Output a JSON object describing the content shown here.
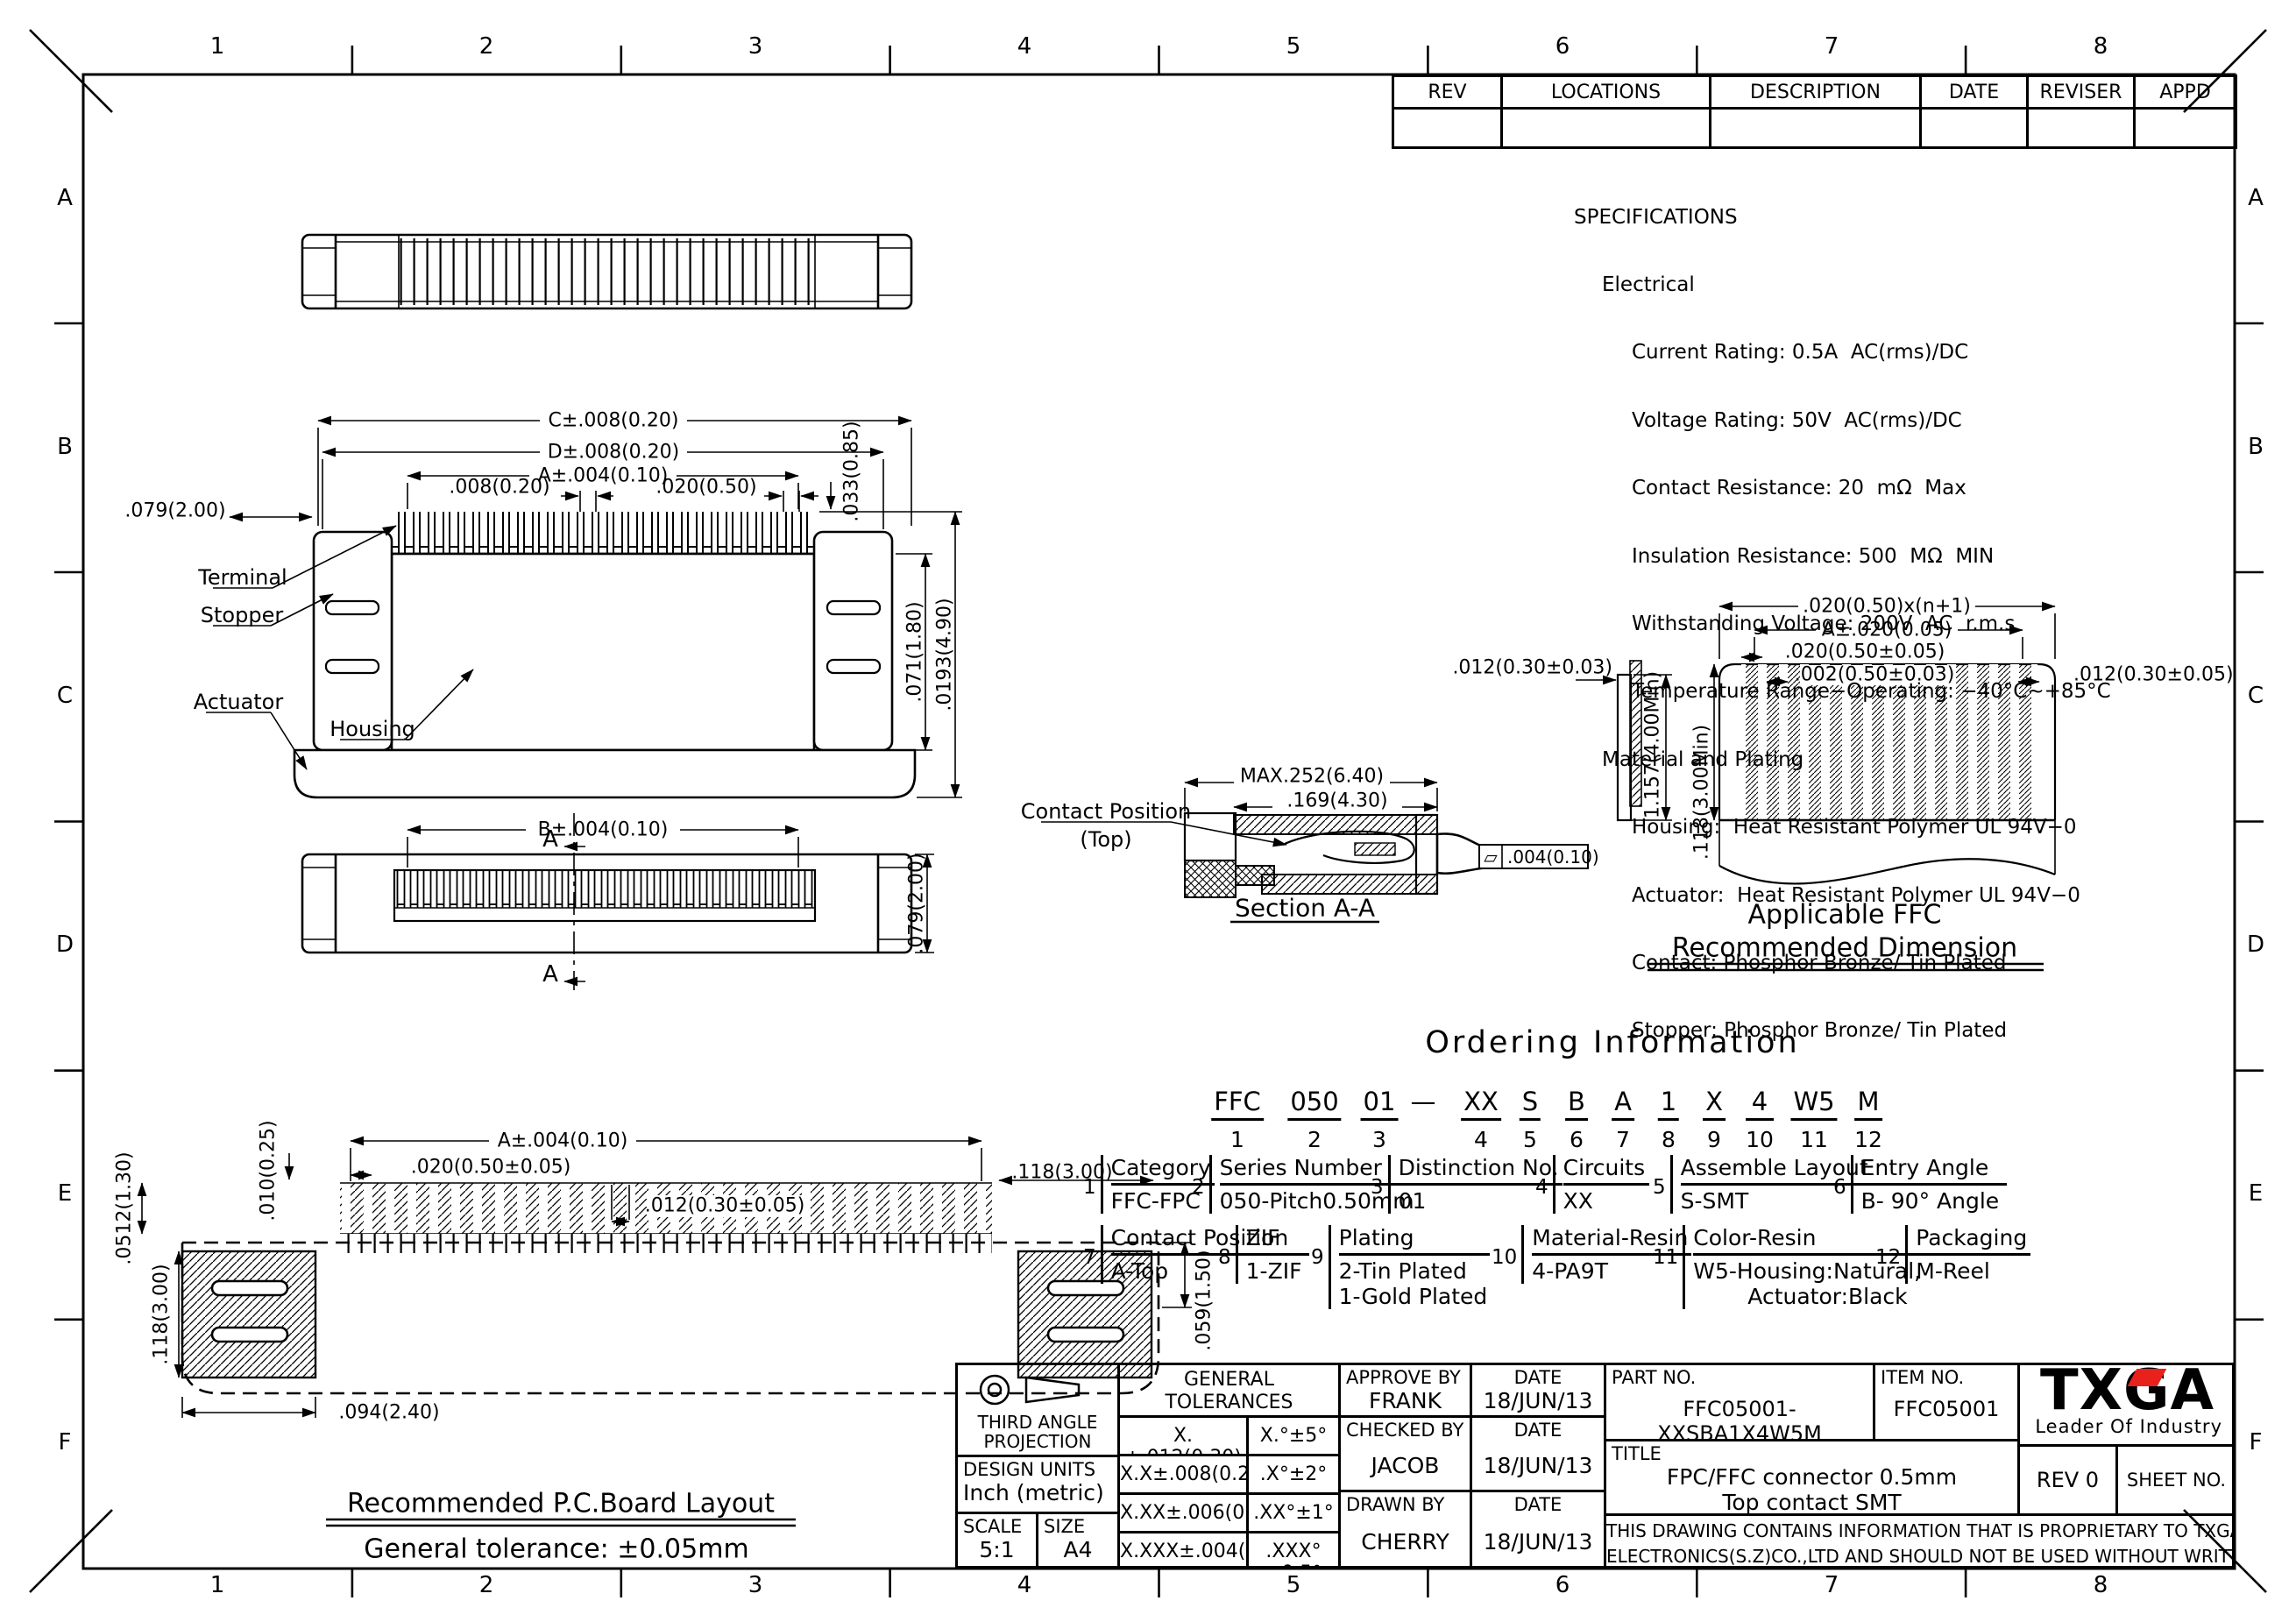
{
  "page": {
    "bg": "#ffffff",
    "ink": "#000000",
    "accent_red": "#e8211d"
  },
  "frame": {
    "cols": [
      "1",
      "2",
      "3",
      "4",
      "5",
      "6",
      "7",
      "8"
    ],
    "rows": [
      "A",
      "B",
      "C",
      "D",
      "E",
      "F"
    ]
  },
  "rev_table": {
    "headers": [
      "REV",
      "LOCATIONS",
      "DESCRIPTION",
      "DATE",
      "REVISER",
      "APPD"
    ]
  },
  "specs": {
    "title": "SPECIFICATIONS",
    "s1_head": "Electrical",
    "s1_lines": [
      "Current Rating: 0.5A  AC(rms)/DC",
      "Voltage Rating: 50V  AC(rms)/DC",
      "Contact Resistance: 20  mΩ  Max",
      "Insulation Resistance: 500  MΩ  MIN",
      "Withstanding Voltage: 200V  AC  r.m.s",
      "Temperature Range−Operating: −40°C~+85°C"
    ],
    "s2_head": "Material and Plating",
    "s2_lines": [
      "Housing:  Heat Resistant Polymer UL 94V−0",
      "Actuator:  Heat Resistant Polymer UL 94V−0",
      "Contact: Phosphor Bronze/ Tin Plated",
      "Stopper: Phosphor Bronze/ Tin Plated"
    ]
  },
  "views": {
    "front": {
      "dim_c": "C±.008(0.20)",
      "dim_d": "D±.008(0.20)",
      "dim_a": "A±.004(0.10)",
      "dim_pitch_a": ".008(0.20)",
      "dim_pitch_b": ".020(0.50)",
      "dim_left": ".079(2.00)",
      "dim_top": ".033(0.85)",
      "dim_h1": ".071(1.80)",
      "dim_h2": ".0193(4.90)",
      "terminal": "Terminal",
      "stopper": "Stopper",
      "actuator": "Actuator",
      "housing": "Housing"
    },
    "bottom": {
      "dim_b": "B±.004(0.10)",
      "dim_h": ".079(2.00)",
      "section": "A"
    },
    "section": {
      "dim_max": "MAX.252(6.40)",
      "dim_inner": ".169(4.30)",
      "contact_1": "Contact Position",
      "contact_2": "(Top)",
      "flat_sym": "▱",
      "flat_val": ".004(0.10)",
      "caption": "Section A-A"
    },
    "ffc": {
      "dim_thk": ".012(0.30±0.03)",
      "dim_len": "1.157(4.00Min)",
      "dim_exp": ".118(3.00Min)",
      "dim_total": ".020(0.50)x(n+1)",
      "dim_a": "A±.020(0.05)",
      "dim_pitch": ".020(0.50±0.05)",
      "dim_w": ".002(0.50±0.03)",
      "dim_r": ".012(0.30±0.05)",
      "cap1": "Applicable FFC",
      "cap2": "Recommended Dimension"
    },
    "pcb": {
      "dim_a": "A±.004(0.10)",
      "dim_010": ".010(0.25)",
      "dim_pitch": ".020(0.50±0.05)",
      "dim_118": ".118(3.00)",
      "dim_pad": ".012(0.30±0.05)",
      "dim_0512": ".0512(1.30)",
      "dim_118b": ".118(3.00)",
      "dim_059": ".059(1.50)",
      "dim_094": ".094(2.40)",
      "cap1": "Recommended P.C.Board Layout",
      "cap2": "General tolerance:  ±0.05mm"
    }
  },
  "ordering": {
    "title": "Ordering Information",
    "code": [
      {
        "t": "FFC",
        "n": "1"
      },
      {
        "t": "050",
        "n": "2"
      },
      {
        "t": "01",
        "n": "3"
      },
      {
        "t": "—",
        "n": ""
      },
      {
        "t": "XX",
        "n": "4"
      },
      {
        "t": "S",
        "n": "5"
      },
      {
        "t": "B",
        "n": "6"
      },
      {
        "t": "A",
        "n": "7"
      },
      {
        "t": "1",
        "n": "8"
      },
      {
        "t": "X",
        "n": "9"
      },
      {
        "t": "4",
        "n": "10"
      },
      {
        "t": "W5",
        "n": "11"
      },
      {
        "t": "M",
        "n": "12"
      }
    ],
    "cells": [
      {
        "n": "1",
        "h": "Category",
        "v": "FFC-FPC"
      },
      {
        "n": "2",
        "h": "Series Number",
        "v": "050-Pitch0.50mm"
      },
      {
        "n": "3",
        "h": "Distinction No.",
        "v": "01"
      },
      {
        "n": "4",
        "h": "Circuits",
        "v": "XX"
      },
      {
        "n": "5",
        "h": "Assemble Layout",
        "v": "S-SMT"
      },
      {
        "n": "6",
        "h": "Entry Angle",
        "v": "B- 90° Angle"
      },
      {
        "n": "7",
        "h": "Contact Position",
        "v": "A-Top"
      },
      {
        "n": "8",
        "h": "ZIF",
        "v": "1-ZIF"
      },
      {
        "n": "9",
        "h": "Plating",
        "v": "2-Tin Plated",
        "v2": "1-Gold Plated"
      },
      {
        "n": "10",
        "h": "Material-Resin",
        "v": "4-PA9T"
      },
      {
        "n": "11",
        "h": "Color-Resin",
        "v": "W5-Housing:Natural,",
        "v2": "Actuator:Black"
      },
      {
        "n": "12",
        "h": "Packaging",
        "v": "M-Reel"
      }
    ]
  },
  "title_block": {
    "proj1": "THIRD ANGLE",
    "proj2": "PROJECTION",
    "units1": "DESIGN UNITS",
    "units2": "Inch (metric)",
    "scale_label": "SCALE",
    "scale": "5:1",
    "size_label": "SIZE",
    "size": "A4",
    "tol_title1": "GENERAL TOLERANCES",
    "tol_title2": "(UNLESS SPECIFIED)",
    "tol": [
      [
        "X.±.012(0.30)",
        "X.°±5°"
      ],
      [
        "X.X±.008(0.20)",
        ".X°±2°"
      ],
      [
        "X.XX±.006(0.15)",
        ".XX°±1°"
      ],
      [
        "X.XXX±.004(0.10)",
        ".XXX°±0.5°"
      ]
    ],
    "approve_label": "APPROVE BY",
    "approve": "FRANK",
    "checked_label": "CHECKED BY",
    "checked": "JACOB",
    "drawn_label": "DRAWN BY",
    "drawn": "CHERRY",
    "date_label": "DATE",
    "date_a": "18/JUN/13",
    "date_b": "18/JUN/13",
    "date_c": "18/JUN/13",
    "part_label": "PART NO.",
    "part": "FFC05001-XXSBA1X4W5M",
    "item_label": "ITEM NO.",
    "item": "FFC05001",
    "title_label": "TITLE",
    "title1": "FPC/FFC connector  0.5mm",
    "title2": "Top contact   SMT",
    "logo": "TXGA",
    "tagline": "Leader Of Industry",
    "rev": "REV 0",
    "sheet": "SHEET NO. 1/5",
    "notice1": "THIS DRAWING CONTAINS INFORMATION THAT IS PROPRIETARY TO TXGA INDUSTRIAL",
    "notice2": "ELECTRONICS(S.Z)CO.,LTD AND SHOULD NOT BE USED WITHOUT WRITTEN PERMISSION"
  }
}
